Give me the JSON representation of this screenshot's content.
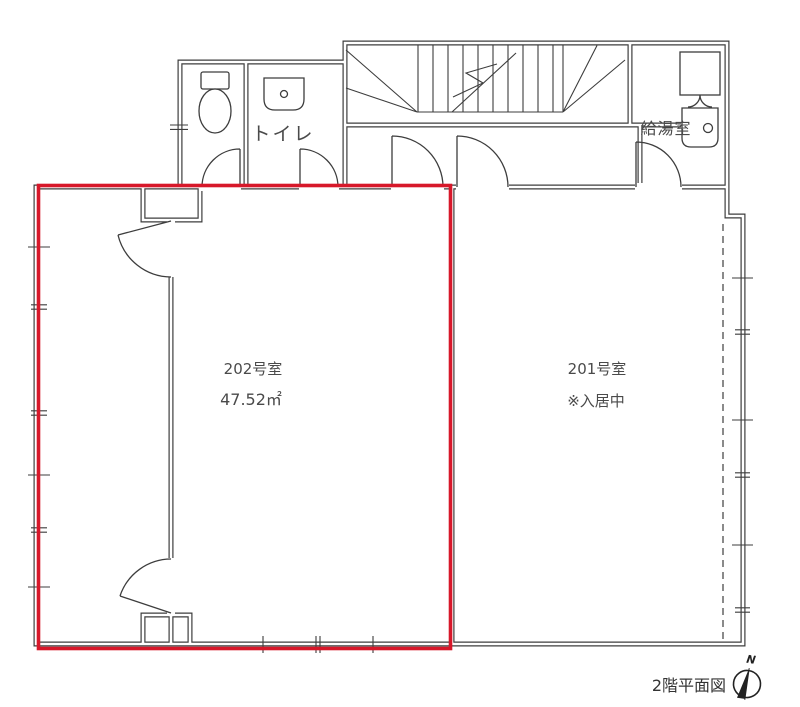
{
  "title": "2階平面図",
  "compass": {
    "north_label": "N"
  },
  "rooms": {
    "toilet": {
      "label": "トイレ"
    },
    "kitchenette": {
      "label": "給湯室"
    },
    "unit_202": {
      "number": "202号室",
      "area": "47.52㎡"
    },
    "unit_201": {
      "number": "201号室",
      "status": "※入居中"
    }
  },
  "colors": {
    "highlight": "#d7182a",
    "wall": "#3d3d3d",
    "text": "#4a4a4a"
  }
}
